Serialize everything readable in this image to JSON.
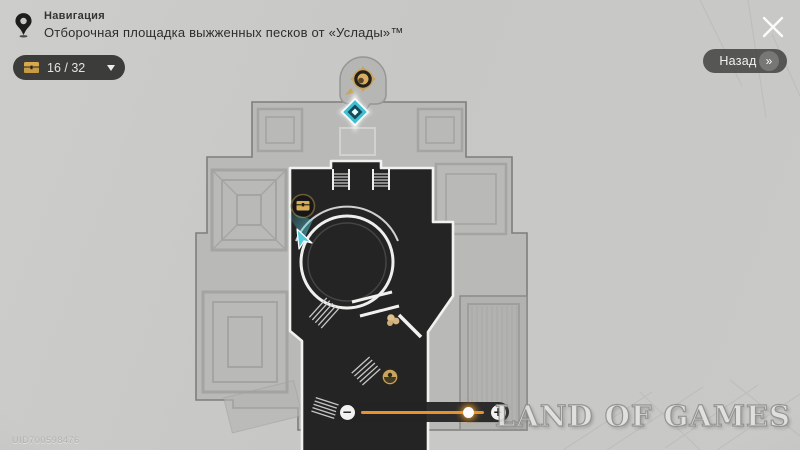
{
  "header": {
    "nav_label": "Навигация",
    "map_title": "Отборочная площадка выжженных песков от «Услады»™"
  },
  "chest_counter": {
    "display": "16 / 32",
    "icon": "chest-icon"
  },
  "back_button": {
    "label": "Назад",
    "chevron": "»"
  },
  "close_button": {
    "icon": "close-icon"
  },
  "zoom_slider": {
    "minus_label": "−",
    "plus_label": "+",
    "value_percent": 87,
    "accent_color": "#e8922e"
  },
  "watermark": {
    "text": "LAND OF GAMES"
  },
  "uid": {
    "text": "UID700598476"
  },
  "map": {
    "markers": [
      {
        "name": "npc-marker",
        "icon": "npc-compass-icon",
        "color": "#c9a45c"
      },
      {
        "name": "teleport-anchor-marker",
        "icon": "space-anchor-icon",
        "color": "#41bed2"
      },
      {
        "name": "chest-marker",
        "icon": "chest-icon",
        "color": "#d9ac58"
      },
      {
        "name": "player-marker",
        "icon": "player-arrow-icon",
        "color": "#54cbdd"
      },
      {
        "name": "enemy-marker",
        "icon": "enemy-icon",
        "color": "#d9bd8a"
      },
      {
        "name": "elite-enemy-marker",
        "icon": "elite-enemy-icon",
        "color": "#c9a45e"
      }
    ],
    "colors": {
      "explored": "#242424",
      "walls": "#f1f1ef",
      "building": "#b9b9b7",
      "background": "#c7c7c5"
    }
  }
}
